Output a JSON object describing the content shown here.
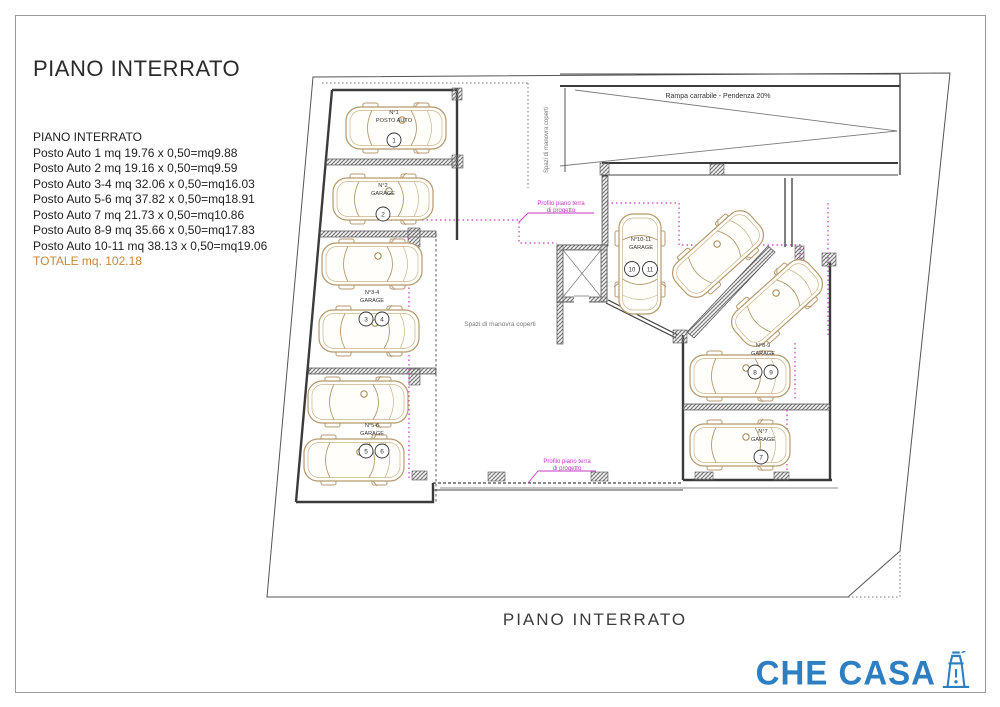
{
  "page": {
    "title": "PIANO INTERRATO",
    "caption": "PIANO INTERRATO"
  },
  "measurements": {
    "heading": "PIANO INTERRATO",
    "rows": [
      "Posto Auto 1 mq 19.76 x 0,50=mq9.88",
      "Posto Auto 2 mq 19.16 x 0,50=mq9.59",
      "Posto Auto 3-4 mq 32.06 x 0,50=mq16.03",
      "Posto Auto 5-6 mq 37.82 x 0,50=mq18.91",
      "Posto Auto 7 mq 21.73 x 0,50=mq10.86",
      "Posto Auto 8-9 mq 35.66 x 0,50=mq17.83",
      "Posto Auto 10-11 mq 38.13 x 0,50=mq19.06"
    ],
    "total": "TOTALE mq. 102.18"
  },
  "plan": {
    "ramp_label": "Rampa carrabile - Pendenza 20%",
    "maneuver_top": "Spazi di manovra coperti",
    "maneuver_center": "Spazi di manovra coperti",
    "profile_top": {
      "line1": "Profilo piano terra",
      "line2": "di progetto"
    },
    "profile_bottom": {
      "line1": "Profilo piano terra",
      "line2": "di progetto"
    }
  },
  "stalls": [
    {
      "line1": "N°1",
      "line2": "POSTO AUTO",
      "numbers": [
        "1"
      ]
    },
    {
      "line1": "N°2",
      "line2": "GARAGE",
      "numbers": [
        "2"
      ]
    },
    {
      "line1": "N°3-4",
      "line2": "GARAGE",
      "numbers": [
        "3",
        "4"
      ]
    },
    {
      "line1": "N°5-6",
      "line2": "GARAGE",
      "numbers": [
        "5",
        "6"
      ]
    },
    {
      "line1": "N°7",
      "line2": "GARAGE",
      "numbers": [
        "7"
      ]
    },
    {
      "line1": "N°8-9",
      "line2": "GARAGE",
      "numbers": [
        "8",
        "9"
      ]
    },
    {
      "line1": "N°10-11",
      "line2": "GARAGE",
      "numbers": [
        "10",
        "11"
      ]
    }
  ],
  "logo": {
    "text": "CHE CASA",
    "icon": "lighthouse-icon"
  },
  "colors": {
    "total_orange": "#c5873c",
    "profile_magenta": "#c338c3",
    "car_tan": "#b49a6e",
    "logo_blue": "#2e7fc2"
  }
}
